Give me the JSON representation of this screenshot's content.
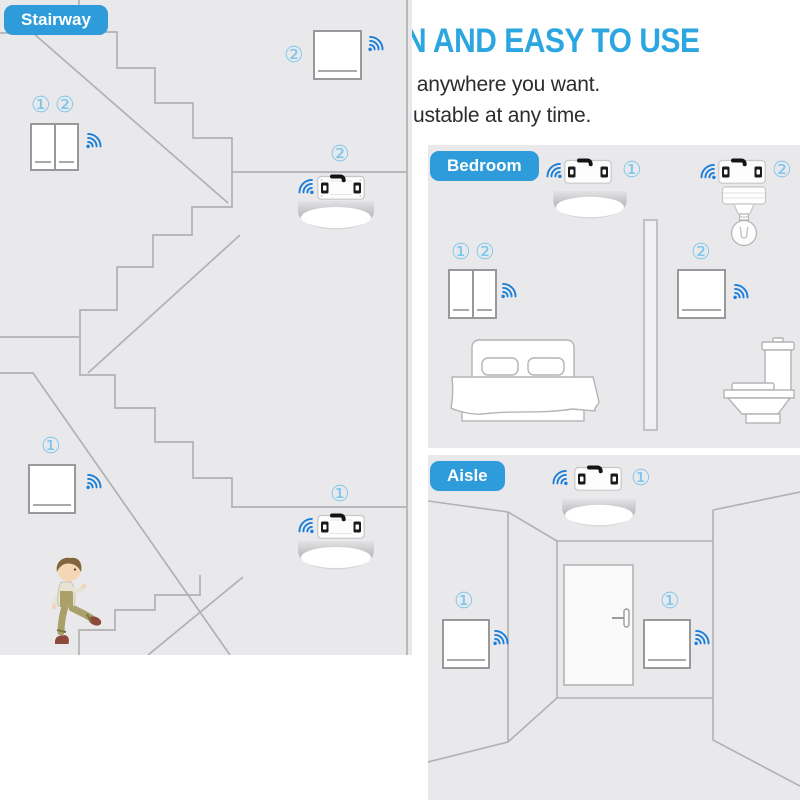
{
  "header": {
    "title": "SIMPLE INSTALLATION AND EASY TO USE",
    "subtitle_line1": "Stick the wall switch on anywhere you want.",
    "subtitle_line2": "Simple installation,  adjustable at any time."
  },
  "panels": {
    "stairway": {
      "label": "Stairway",
      "upper_switch_badge": "②",
      "wall_switch_badges": [
        "①",
        "②"
      ],
      "upper_receiver_badge": "②",
      "lower_switch_badge": "①",
      "lower_receiver_badge": "①"
    },
    "bedroom": {
      "label": "Bedroom",
      "ceiling_receiver_badge": "①",
      "lamp_receiver_badge": "②",
      "wall_switch_badges": [
        "①",
        "②"
      ],
      "right_switch_badge": "②"
    },
    "aisle": {
      "label": "Aisle",
      "ceiling_receiver_badge": "①",
      "left_switch_badge": "①",
      "right_switch_badge": "①"
    }
  },
  "icons": {
    "wifi": "wifi-signal-icon",
    "receiver": "relay-receiver-module",
    "ceiling_light": "ceiling-light",
    "pendant_lamp": "pendant-bulb-lamp",
    "badges": "circled-number"
  },
  "colors": {
    "title": "#2BA6E0",
    "tag_bg": "#2E9CDA",
    "badge": "#7CC6EC",
    "wifi": "#1B7ED9",
    "panel_bg": "#E9E9EB",
    "wall_line": "#B1B1B3"
  }
}
